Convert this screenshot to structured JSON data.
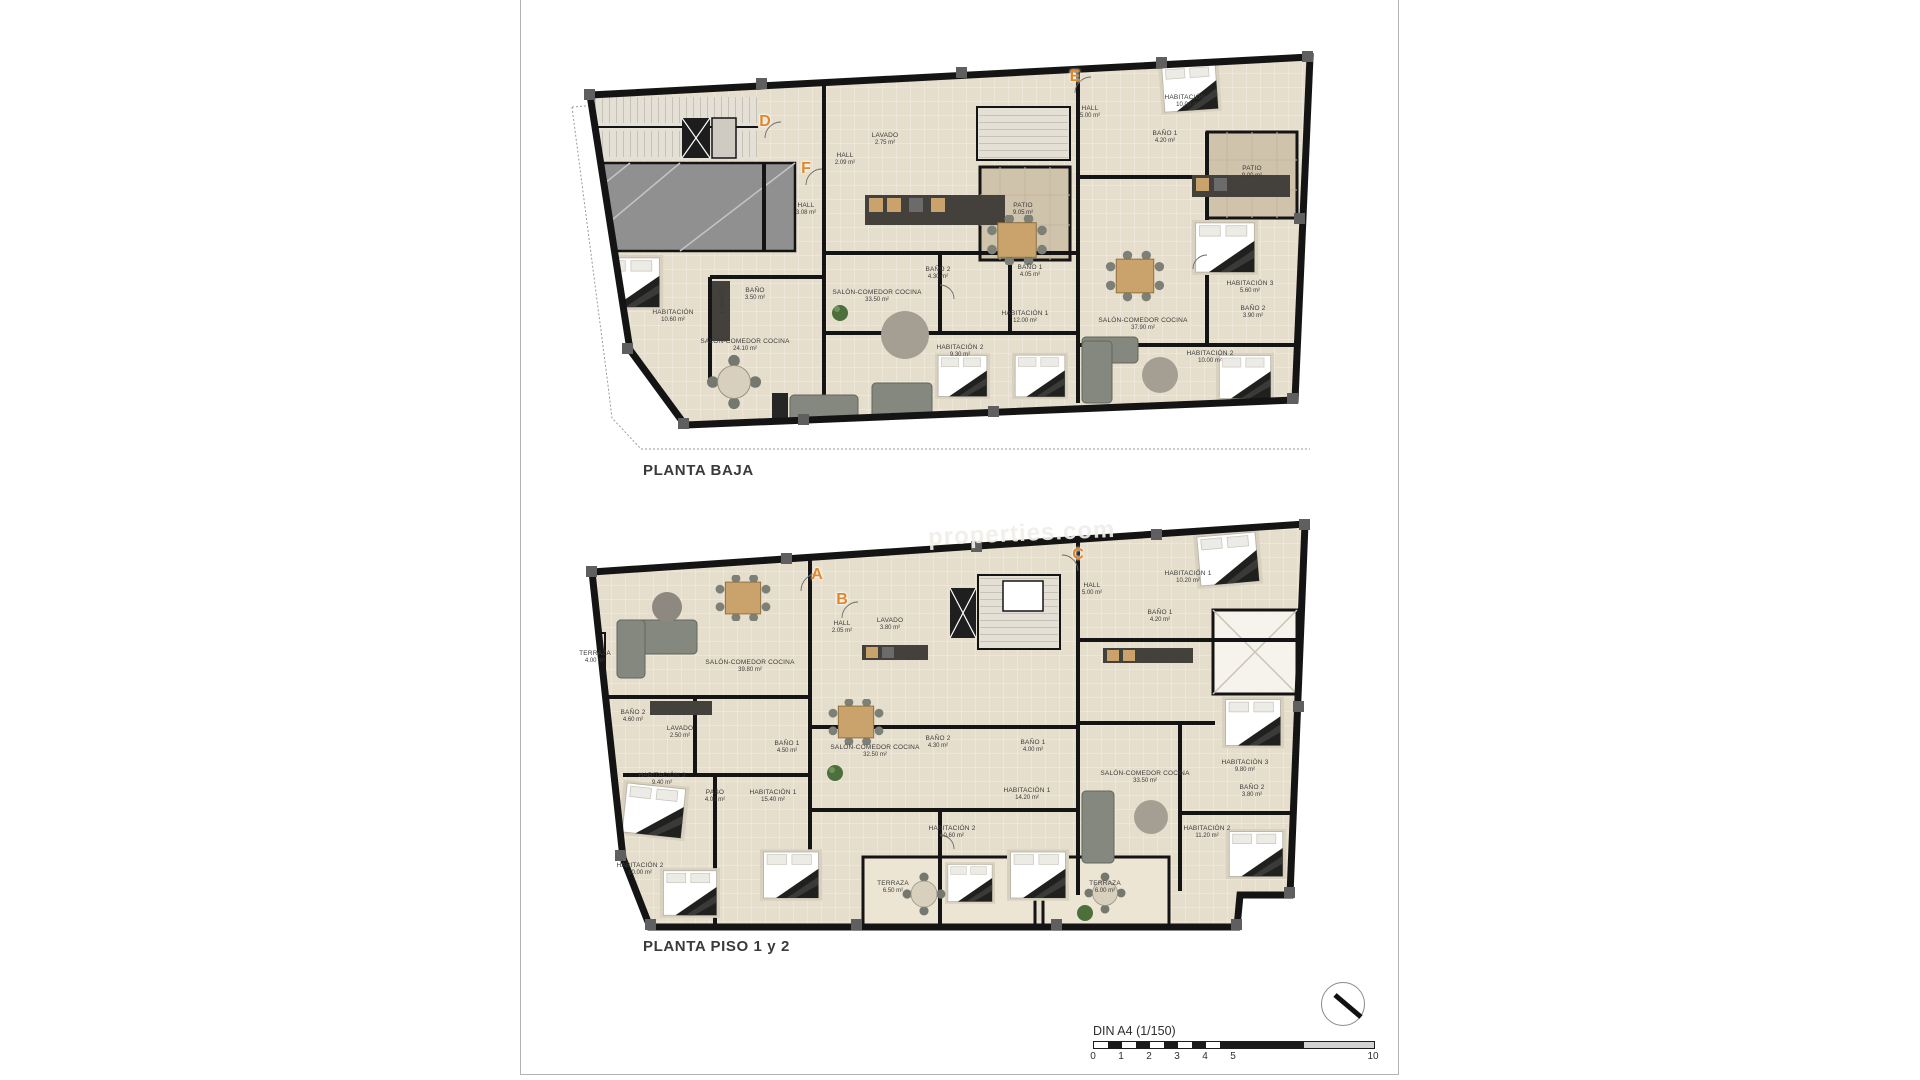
{
  "sheet": {
    "watermark": "properties.com",
    "scale_bar": {
      "label": "DIN A4 (1/150)",
      "ticks": [
        {
          "label": "0",
          "u": 0
        },
        {
          "label": "1",
          "u": 1
        },
        {
          "label": "2",
          "u": 2
        },
        {
          "label": "3",
          "u": 3
        },
        {
          "label": "4",
          "u": 4
        },
        {
          "label": "5",
          "u": 5
        },
        {
          "label": "10",
          "u": 10
        }
      ]
    },
    "compass": "north-arrow",
    "accent_color": "#e2862b"
  },
  "plans": [
    {
      "id": "planta-baja",
      "title": "PLANTA BAJA",
      "markers": [
        {
          "letter": "D",
          "x": 765,
          "y": 122
        },
        {
          "letter": "F",
          "x": 806,
          "y": 169
        },
        {
          "letter": "E",
          "x": 1075,
          "y": 77
        }
      ],
      "rooms": [
        {
          "name": "HABITACIÓN",
          "area": "10.60 m²",
          "x": 673,
          "y": 317
        },
        {
          "name": "BAÑO",
          "area": "3.50 m²",
          "x": 755,
          "y": 295
        },
        {
          "name": "SALÓN-COMEDOR COCINA",
          "area": "24.10 m²",
          "x": 745,
          "y": 346
        },
        {
          "name": "HALL",
          "area": "3.08 m²",
          "x": 806,
          "y": 210
        },
        {
          "name": "LAVADO",
          "area": "",
          "x": 723,
          "y": 300,
          "rot": -90
        },
        {
          "name": "HALL",
          "area": "2.09 m²",
          "x": 845,
          "y": 160
        },
        {
          "name": "LAVADO",
          "area": "2.75 m²",
          "x": 885,
          "y": 140
        },
        {
          "name": "SALÓN-COMEDOR COCINA",
          "area": "33.50 m²",
          "x": 877,
          "y": 297
        },
        {
          "name": "BAÑO 2",
          "area": "4.30 m²",
          "x": 938,
          "y": 274
        },
        {
          "name": "BAÑO 1",
          "area": "4.05 m²",
          "x": 1030,
          "y": 272
        },
        {
          "name": "HABITACIÓN 2",
          "area": "9.30 m²",
          "x": 960,
          "y": 352
        },
        {
          "name": "HABITACIÓN 1",
          "area": "12.00 m²",
          "x": 1025,
          "y": 318
        },
        {
          "name": "PATIO",
          "area": "9.05 m²",
          "x": 1023,
          "y": 210
        },
        {
          "name": "HALL",
          "area": "5.00 m²",
          "x": 1090,
          "y": 113
        },
        {
          "name": "HABITACIÓN 1",
          "area": "10.00 m²",
          "x": 1188,
          "y": 102
        },
        {
          "name": "BAÑO 1",
          "area": "4.20 m²",
          "x": 1165,
          "y": 138
        },
        {
          "name": "PATIO",
          "area": "9.00 m²",
          "x": 1252,
          "y": 173
        },
        {
          "name": "SALÓN-COMEDOR COCINA",
          "area": "37.90 m²",
          "x": 1143,
          "y": 325
        },
        {
          "name": "HABITACIÓN 3",
          "area": "5.60 m²",
          "x": 1250,
          "y": 288
        },
        {
          "name": "BAÑO 2",
          "area": "3.90 m²",
          "x": 1253,
          "y": 313
        },
        {
          "name": "HABITACIÓN 2",
          "area": "10.00 m²",
          "x": 1210,
          "y": 358
        }
      ]
    },
    {
      "id": "planta-piso-1-2",
      "title": "PLANTA PISO 1 y 2",
      "markers": [
        {
          "letter": "A",
          "x": 817,
          "y": 575
        },
        {
          "letter": "B",
          "x": 842,
          "y": 600
        },
        {
          "letter": "C",
          "x": 1078,
          "y": 555
        }
      ],
      "rooms": [
        {
          "name": "TERRAZA",
          "area": "4.00 m²",
          "x": 595,
          "y": 658
        },
        {
          "name": "SALÓN-COMEDOR COCINA",
          "area": "39.80 m²",
          "x": 750,
          "y": 667
        },
        {
          "name": "HALL",
          "area": "2.05 m²",
          "x": 842,
          "y": 628
        },
        {
          "name": "LAVADO",
          "area": "3.80 m²",
          "x": 890,
          "y": 625
        },
        {
          "name": "BAÑO 2",
          "area": "4.60 m²",
          "x": 633,
          "y": 717
        },
        {
          "name": "LAVADO",
          "area": "2.50 m²",
          "x": 680,
          "y": 733
        },
        {
          "name": "BAÑO 1",
          "area": "4.50 m²",
          "x": 787,
          "y": 748
        },
        {
          "name": "SALÓN-COMEDOR COCINA",
          "area": "32.50 m²",
          "x": 875,
          "y": 752
        },
        {
          "name": "BAÑO 2",
          "area": "4.30 m²",
          "x": 938,
          "y": 743
        },
        {
          "name": "HABITACIÓN 3",
          "area": "9.40 m²",
          "x": 662,
          "y": 780
        },
        {
          "name": "PASO",
          "area": "4.00 m²",
          "x": 715,
          "y": 797
        },
        {
          "name": "HABITACIÓN 1",
          "area": "15.40 m²",
          "x": 773,
          "y": 797
        },
        {
          "name": "HABITACIÓN 2",
          "area": "10.00 m²",
          "x": 640,
          "y": 870
        },
        {
          "name": "TERRAZA",
          "area": "6.50 m²",
          "x": 893,
          "y": 888
        },
        {
          "name": "HABITACIÓN 2",
          "area": "10.60 m²",
          "x": 952,
          "y": 833
        },
        {
          "name": "BAÑO 1",
          "area": "4.00 m²",
          "x": 1033,
          "y": 747
        },
        {
          "name": "HABITACIÓN 1",
          "area": "14.20 m²",
          "x": 1027,
          "y": 795
        },
        {
          "name": "HALL",
          "area": "5.00 m²",
          "x": 1092,
          "y": 590
        },
        {
          "name": "HABITACIÓN 1",
          "area": "10.20 m²",
          "x": 1188,
          "y": 578
        },
        {
          "name": "BAÑO 1",
          "area": "4.20 m²",
          "x": 1160,
          "y": 617
        },
        {
          "name": "SALÓN-COMEDOR COCINA",
          "area": "33.50 m²",
          "x": 1145,
          "y": 778
        },
        {
          "name": "HABITACIÓN 3",
          "area": "9.80 m²",
          "x": 1245,
          "y": 767
        },
        {
          "name": "BAÑO 2",
          "area": "3.80 m²",
          "x": 1252,
          "y": 792
        },
        {
          "name": "HABITACIÓN 2",
          "area": "11.20 m²",
          "x": 1207,
          "y": 833
        },
        {
          "name": "TERRAZA",
          "area": "6.00 m²",
          "x": 1105,
          "y": 888
        }
      ]
    }
  ]
}
